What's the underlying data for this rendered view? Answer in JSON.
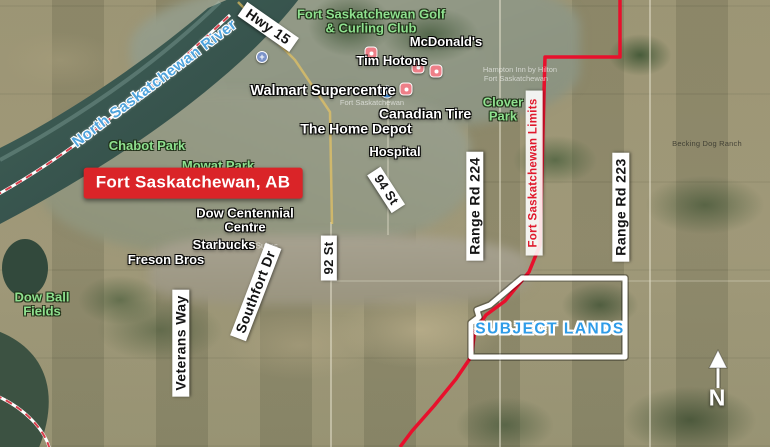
{
  "banner": {
    "text": "Fort Saskatchewan, AB"
  },
  "water": {
    "river": "North Saskatchewan River"
  },
  "roads": {
    "hwy15": "Hwy 15",
    "st94": "94 St",
    "st92": "92 St",
    "rr224": "Range Rd 224",
    "rr223": "Range Rd 223",
    "veterans": "Veterans Way",
    "southfort": "Southfort Dr"
  },
  "boundary": {
    "limits": "Fort Saskatchewan Limits"
  },
  "parks": {
    "golf_line1": "Fort Saskatchewan Golf",
    "golf_line2": "& Curling Club",
    "chabot": "Chabot Park",
    "mowat": "Mowat Park",
    "clover_line1": "Clover",
    "clover_line2": "Park",
    "dowball_line1": "Dow Ball",
    "dowball_line2": "Fields"
  },
  "pois": {
    "mcdonalds": "McDonald's",
    "tim_hortons": "Tim Hotons",
    "walmart": "Walmart Supercentre",
    "canadian_tire": "Canadian Tire",
    "home_depot": "The Home Depot",
    "hospital": "Hospital",
    "dow_centennial_line1": "Dow Centennial",
    "dow_centennial_line2": "Centre",
    "starbucks": "Starbucks",
    "suites": "& Suites",
    "freson": "Freson Bros"
  },
  "overlay": {
    "subject_lands": "SUBJECT LANDS"
  },
  "compass": {
    "north": "N"
  },
  "base_map_text": {
    "ranch": "Becking Dog Ranch",
    "fort_sask": "Fort Saskatchewan",
    "hampton_line1": "Hampton Inn by Hilton",
    "hampton_line2": "Fort Saskatchewan"
  },
  "colors": {
    "banner_red": "#da2428",
    "limits_text_red": "#e0192c",
    "boundary_line_red": "#e8102c",
    "park_green": "#8fe08f",
    "water_blue": "#4fa3dc",
    "subject_blue": "#2f9ce8",
    "road_label_bg": "#ffffff",
    "subject_outline": "#ffffff",
    "pin_coral": "#ee7f88",
    "pin_blue": "#4a90d9"
  }
}
